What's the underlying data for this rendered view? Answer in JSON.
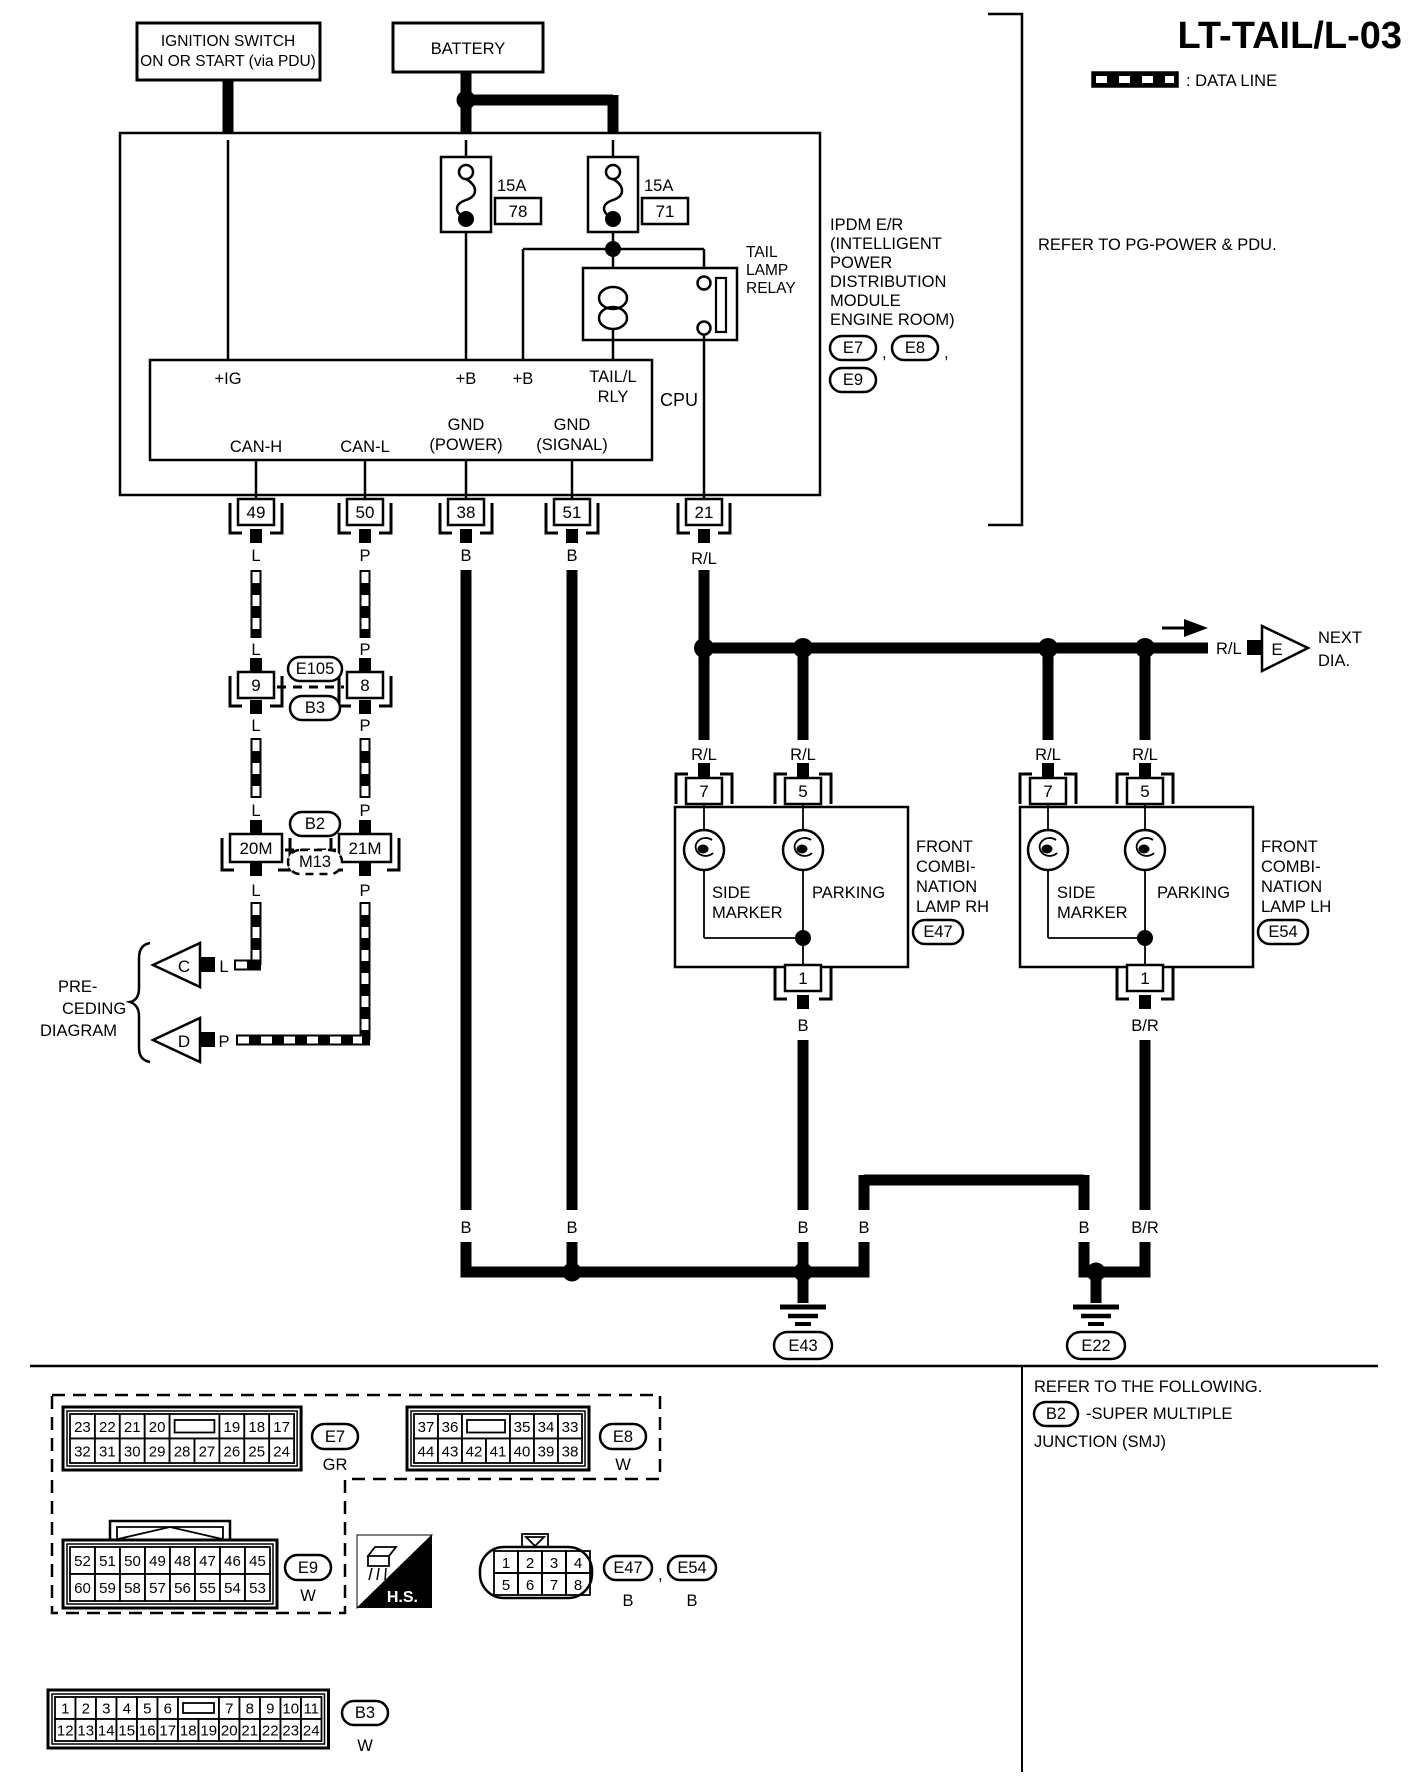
{
  "title": "LT-TAIL/L-03",
  "legend": {
    "data_line_label": ": DATA LINE"
  },
  "top": {
    "ignition_l1": "IGNITION SWITCH",
    "ignition_l2": "ON OR START (via PDU)",
    "battery": "BATTERY"
  },
  "ipdm": {
    "fuse1_amp": "15A",
    "fuse1_no": "78",
    "fuse2_amp": "15A",
    "fuse2_no": "71",
    "relay": [
      "TAIL",
      "LAMP",
      "RELAY"
    ],
    "cpu": "CPU",
    "pin_ig": "+IG",
    "pin_b1": "+B",
    "pin_b2": "+B",
    "pin_rly1": "TAIL/L",
    "pin_rly2": "RLY",
    "pin_canh": "CAN-H",
    "pin_canl": "CAN-L",
    "pin_gndp1": "GND",
    "pin_gndp2": "(POWER)",
    "pin_gnds1": "GND",
    "pin_gnds2": "(SIGNAL)",
    "side": [
      "IPDM E/R",
      "(INTELLIGENT",
      "POWER",
      "DISTRIBUTION",
      "MODULE",
      "ENGINE ROOM)"
    ],
    "ref_e7": "E7",
    "ref_e8": "E8",
    "ref_e9": "E9",
    "comma": ",",
    "refer_note": "REFER TO PG-POWER & PDU."
  },
  "pins": {
    "p49": "49",
    "p50": "50",
    "p38": "38",
    "p51": "51",
    "p21": "21"
  },
  "wire": {
    "l": "L",
    "p": "P",
    "b": "B",
    "rl": "R/L",
    "br": "B/R"
  },
  "mid": {
    "c9": "9",
    "c8": "8",
    "e105": "E105",
    "b3": "B3",
    "b2": "B2",
    "m13": "M13",
    "c20m": "20M",
    "c21m": "21M"
  },
  "preceding": {
    "l1": "PRE-",
    "l2": "CEDING",
    "l3": "DIAGRAM",
    "c": "C",
    "d": "D"
  },
  "next": {
    "e": "E",
    "l1": "NEXT",
    "l2": "DIA."
  },
  "lamps": {
    "rh": [
      "FRONT",
      "COMBI-",
      "NATION",
      "LAMP RH"
    ],
    "lh": [
      "FRONT",
      "COMBI-",
      "NATION",
      "LAMP LH"
    ],
    "side1": "SIDE",
    "side2": "MARKER",
    "parking": "PARKING",
    "rh_conn": "E47",
    "lh_conn": "E54",
    "pin7": "7",
    "pin5": "5",
    "pin1": "1"
  },
  "grounds": {
    "e43": "E43",
    "e22": "E22"
  },
  "footer": {
    "refer": "REFER TO THE FOLLOWING.",
    "b2": "B2",
    "smj1": "-SUPER MULTIPLE",
    "smj2": "JUNCTION (SMJ)",
    "hs": "H.S."
  },
  "grid_labels": {
    "e7": "E7",
    "e7_color": "GR",
    "e8": "E8",
    "e8_color": "W",
    "e9": "E9",
    "e9_color": "W",
    "b3": "B3",
    "b3_color": "W"
  },
  "connector_grids": [
    {
      "name": "E7",
      "x": 63,
      "y": 1407,
      "unit": 24.9,
      "cell_h": 24.5,
      "rows": [
        [
          "23",
          "22",
          "21",
          "20",
          "",
          "19",
          "18",
          "17"
        ],
        [
          "32",
          "31",
          "30",
          "29",
          "28",
          "27",
          "26",
          "25",
          "24"
        ]
      ]
    },
    {
      "name": "E8",
      "x": 407,
      "y": 1407,
      "unit": 24,
      "cell_h": 24.5,
      "rows": [
        [
          "37",
          "36",
          "",
          "35",
          "34",
          "33"
        ],
        [
          "44",
          "43",
          "42",
          "41",
          "40",
          "39",
          "38"
        ]
      ]
    },
    {
      "name": "E9",
      "x": 63,
      "y": 1540,
      "unit": 25,
      "cell_h": 27,
      "rows": [
        [
          "52",
          "51",
          "50",
          "49",
          "48",
          "47",
          "46",
          "45"
        ],
        [
          "60",
          "59",
          "58",
          "57",
          "56",
          "55",
          "54",
          "53"
        ]
      ]
    },
    {
      "name": "B3",
      "x": 48,
      "y": 1690,
      "unit": 20.5,
      "cell_h": 22,
      "rows": [
        [
          "1",
          "2",
          "3",
          "4",
          "5",
          "6",
          "",
          "7",
          "8",
          "9",
          "10",
          "11"
        ],
        [
          "12",
          "13",
          "14",
          "15",
          "16",
          "17",
          "18",
          "19",
          "20",
          "21",
          "22",
          "23",
          "24"
        ]
      ]
    }
  ],
  "e4754": {
    "pins": [
      "1",
      "2",
      "3",
      "4",
      "5",
      "6",
      "7",
      "8"
    ],
    "e47": "E47",
    "e54": "E54",
    "comma": ",",
    "b1": "B",
    "b2": "B"
  }
}
